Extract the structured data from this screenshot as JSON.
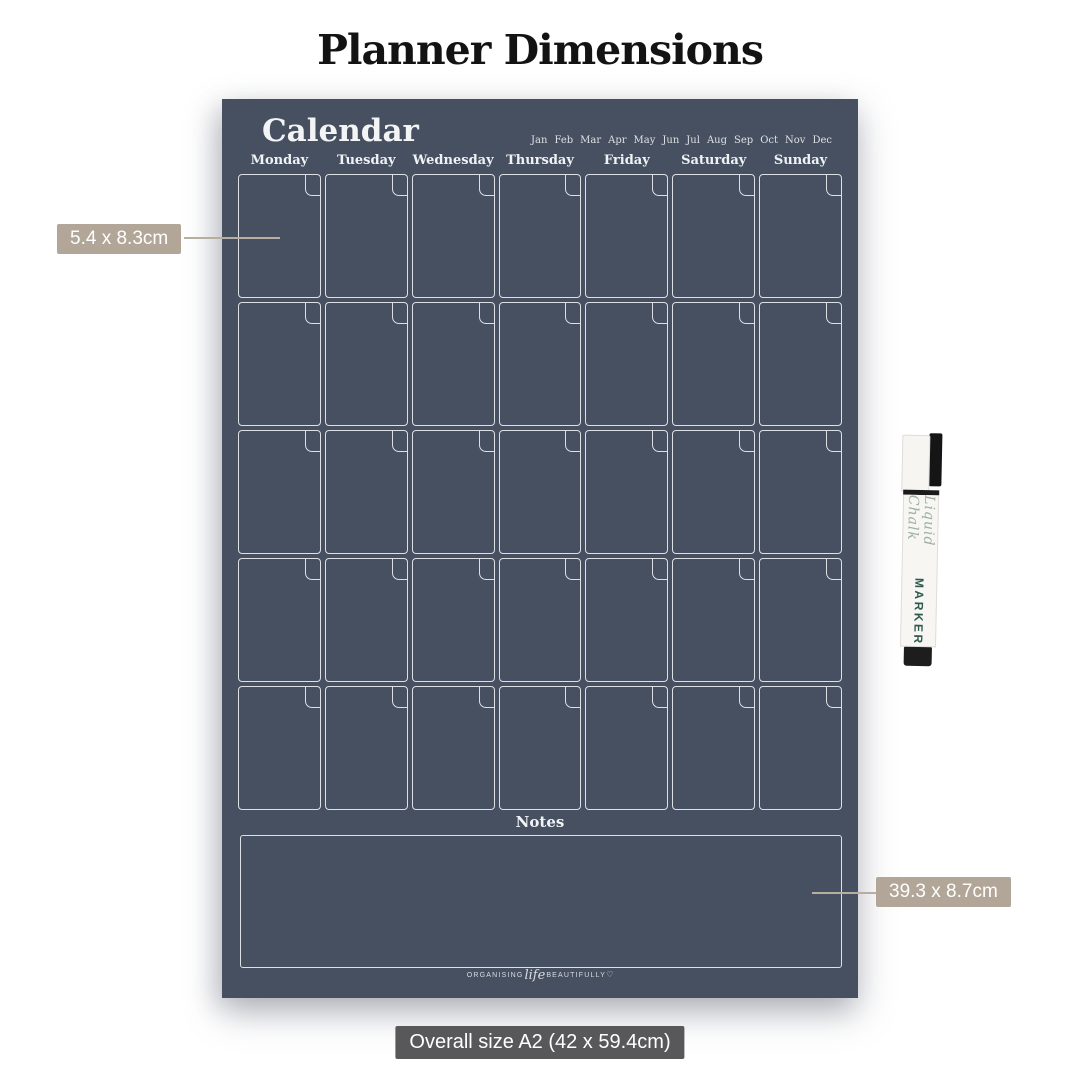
{
  "page": {
    "title": "Planner Dimensions"
  },
  "planner": {
    "title": "Calendar",
    "months": [
      "Jan",
      "Feb",
      "Mar",
      "Apr",
      "May",
      "Jun",
      "Jul",
      "Aug",
      "Sep",
      "Oct",
      "Nov",
      "Dec"
    ],
    "days": [
      "Monday",
      "Tuesday",
      "Wednesday",
      "Thursday",
      "Friday",
      "Saturday",
      "Sunday"
    ],
    "weeks": 5,
    "notes_label": "Notes",
    "logo": {
      "left": "ORGANISING",
      "script": "life",
      "right": "BEAUTIFULLY",
      "heart": "♡"
    }
  },
  "annotations": {
    "cell_size": "5.4 x 8.3cm",
    "notes_size": "39.3 x 8.7cm",
    "overall_size": "Overall size A2 (42 x 59.4cm)"
  },
  "marker": {
    "script_text": "Liquid Chalk",
    "brand_text": "MARKER"
  },
  "colors": {
    "board": "#475060",
    "label-bg": "#b2a698",
    "overall-bg": "#58585a",
    "marker-script": "#9cb0a0",
    "marker-brand": "#2f5a4c"
  }
}
